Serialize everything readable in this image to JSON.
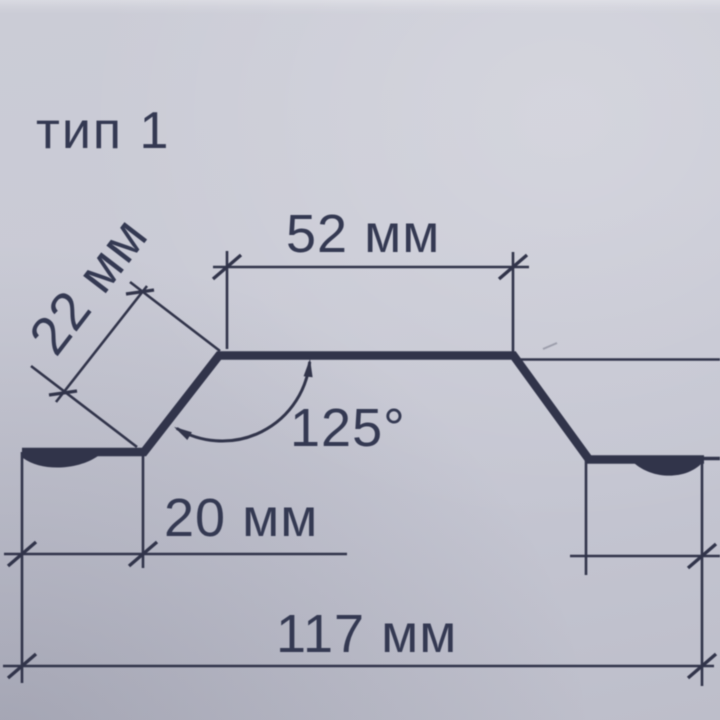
{
  "title": "тип 1",
  "labels": {
    "top_width": "52 мм",
    "side_length": "22 мм",
    "angle": "125°",
    "flange_width": "20 мм",
    "total_width": "117 мм"
  },
  "values": {
    "top_width_mm": 52,
    "side_length_mm": 22,
    "angle_deg": 125,
    "flange_width_mm": 20,
    "total_width_mm": 117
  },
  "colors": {
    "paper": "#c8c9d4",
    "ink": "#31344a"
  }
}
